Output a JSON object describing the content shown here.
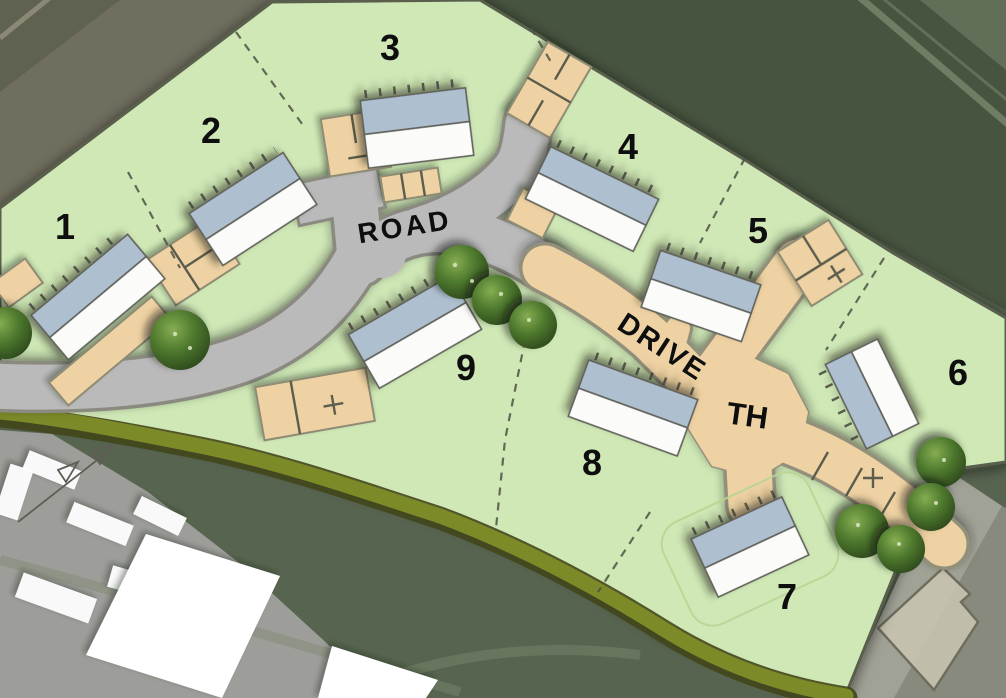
{
  "labels": {
    "road": "ROAD",
    "drive": "DRIVE",
    "turning_head": "TH"
  },
  "plots": [
    {
      "number": "1"
    },
    {
      "number": "2"
    },
    {
      "number": "3"
    },
    {
      "number": "4"
    },
    {
      "number": "5"
    },
    {
      "number": "6"
    },
    {
      "number": "7"
    },
    {
      "number": "8"
    },
    {
      "number": "9"
    }
  ],
  "colors": {
    "site_green": "#cfe8b6",
    "road_gray": "#bababa",
    "road_edge": "#8a8a81",
    "drive_tan": "#eed2a3",
    "drive_edge": "#92907a",
    "roof_blue": "#aebfd0",
    "roof_white": "#fbfbfa",
    "house_outline": "#5f5f58",
    "tree_dark": "#2c451b",
    "tree_light": "#82a950",
    "hedge_olive": "#7d8a28",
    "hedge_dark": "#41461b",
    "aerial_dark": "#47543f",
    "aerial_brown": "#706e5e",
    "aerial_field": "#57644f",
    "yard_gray": "#9d9d9a",
    "building_white": "#ffffff",
    "label_color": "#0e0e0e"
  }
}
